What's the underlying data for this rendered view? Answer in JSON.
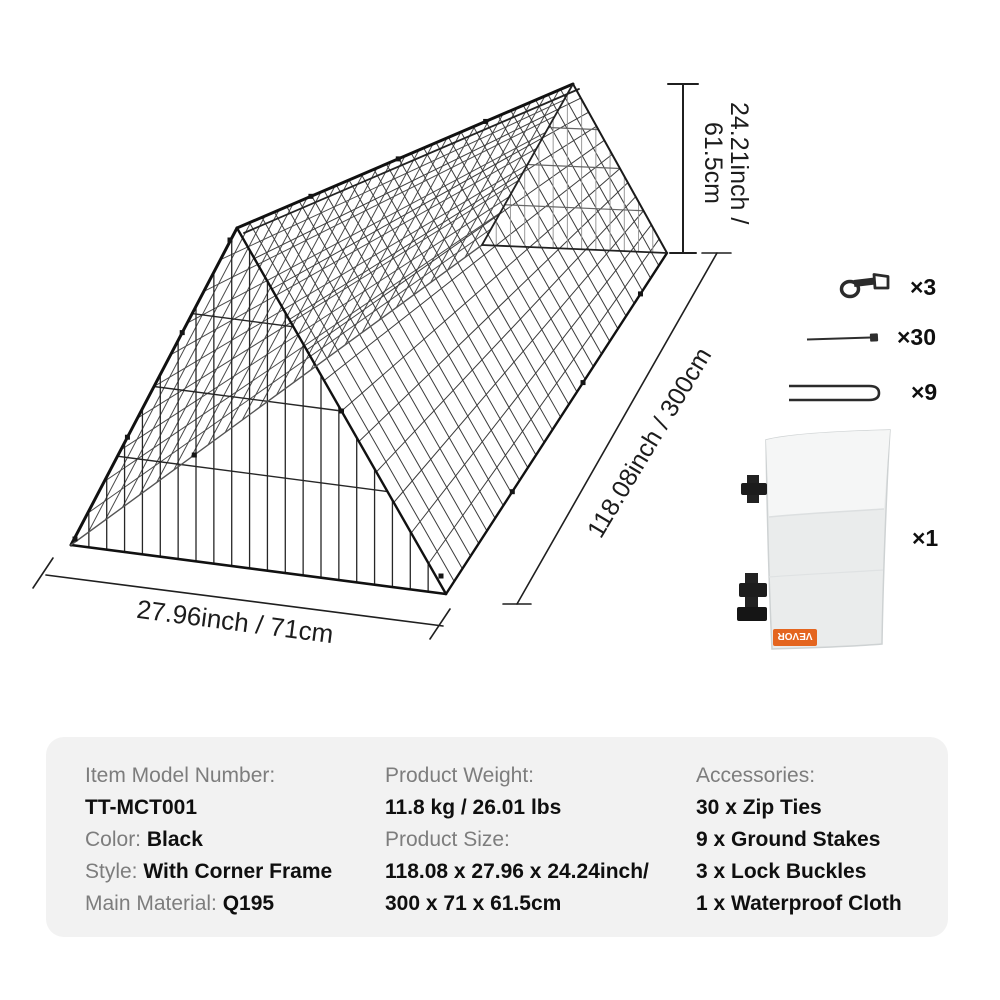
{
  "dimensions": {
    "height_lines": [
      "24.21inch /",
      "61.5cm"
    ],
    "length": "118.08inch / 300cm",
    "width": "27.96inch / 71cm"
  },
  "accessories": {
    "items": [
      {
        "icon": "lock-buckle-icon",
        "qty": "×3"
      },
      {
        "icon": "zip-tie-icon",
        "qty": "×30"
      },
      {
        "icon": "ground-stake-icon",
        "qty": "×9"
      },
      {
        "icon": "waterproof-cloth-image",
        "qty": "×1",
        "tag": "VEVOR"
      }
    ]
  },
  "spec": {
    "columns": [
      {
        "rows": [
          {
            "label": "Item Model Number:",
            "value": ""
          },
          {
            "label": "",
            "value": "TT-MCT001"
          },
          {
            "label": "Color: ",
            "value": "Black"
          },
          {
            "label": "Style: ",
            "value": "With Corner Frame"
          },
          {
            "label": "Main Material: ",
            "value": "Q195"
          }
        ]
      },
      {
        "rows": [
          {
            "label": "Product Weight:",
            "value": ""
          },
          {
            "label": "",
            "value": "11.8 kg / 26.01 lbs"
          },
          {
            "label": "Product Size:",
            "value": ""
          },
          {
            "label": "",
            "value": "118.08 x 27.96 x 24.24inch/"
          },
          {
            "label": "",
            "value": "300 x 71 x 61.5cm"
          }
        ]
      },
      {
        "rows": [
          {
            "label": "Accessories:",
            "value": ""
          },
          {
            "label": "",
            "value": "30 x Zip Ties"
          },
          {
            "label": "",
            "value": "9 x Ground Stakes"
          },
          {
            "label": "",
            "value": "3 x Lock Buckles"
          },
          {
            "label": "",
            "value": "1 x Waterproof Cloth"
          }
        ]
      }
    ]
  },
  "colors": {
    "panel_bg": "#f2f2f2",
    "label_gray": "#7d7d7d",
    "value_black": "#0f0f0f",
    "line_black": "#1f1f1f",
    "tag_orange": "#e4651f"
  }
}
